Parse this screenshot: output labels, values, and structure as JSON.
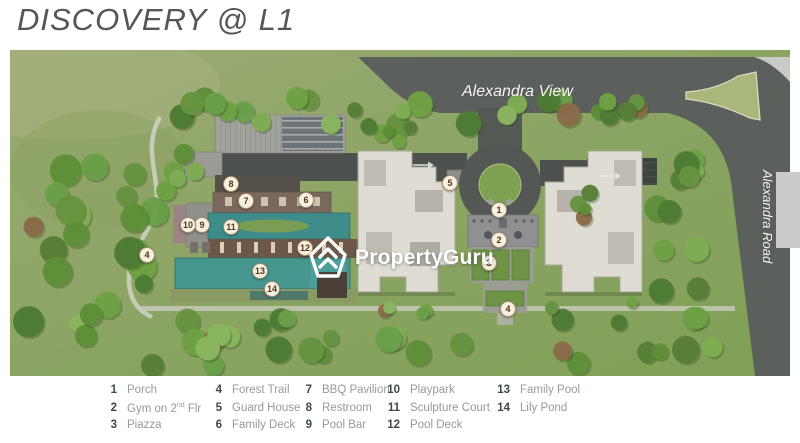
{
  "title": "DISCOVERY @ L1",
  "map": {
    "road_label_top": "Alexandra View",
    "road_label_right": "Alexandra Road",
    "watermark": "PropertyGuru",
    "badges": [
      {
        "num": "1",
        "x": 489,
        "y": 160
      },
      {
        "num": "2",
        "x": 489,
        "y": 190
      },
      {
        "num": "3",
        "x": 479,
        "y": 213
      },
      {
        "num": "4",
        "x": 137,
        "y": 205
      },
      {
        "num": "4",
        "x": 498,
        "y": 259
      },
      {
        "num": "5",
        "x": 440,
        "y": 133
      },
      {
        "num": "6",
        "x": 296,
        "y": 150
      },
      {
        "num": "7",
        "x": 236,
        "y": 151
      },
      {
        "num": "8",
        "x": 221,
        "y": 134
      },
      {
        "num": "9",
        "x": 192,
        "y": 175
      },
      {
        "num": "10",
        "x": 178,
        "y": 175
      },
      {
        "num": "11",
        "x": 221,
        "y": 177
      },
      {
        "num": "12",
        "x": 295,
        "y": 198
      },
      {
        "num": "13",
        "x": 250,
        "y": 221
      },
      {
        "num": "14",
        "x": 262,
        "y": 239
      }
    ]
  },
  "legend": {
    "columns": [
      {
        "items": [
          {
            "num": "1",
            "label": "Porch"
          },
          {
            "num": "2",
            "label_pre": "Gym on 2",
            "label_sup": "nd",
            "label_post": " Flr"
          },
          {
            "num": "3",
            "label": "Piazza"
          }
        ]
      },
      {
        "items": [
          {
            "num": "4",
            "label": "Forest Trail"
          },
          {
            "num": "5",
            "label": "Guard House"
          },
          {
            "num": "6",
            "label": "Family Deck"
          }
        ]
      },
      {
        "items": [
          {
            "num": "7",
            "label": "BBQ Pavilion"
          },
          {
            "num": "8",
            "label": "Restroom"
          },
          {
            "num": "9",
            "label": "Pool Bar"
          }
        ]
      },
      {
        "items": [
          {
            "num": "10",
            "label": "Playpark"
          },
          {
            "num": "11",
            "label": "Sculpture Court"
          },
          {
            "num": "12",
            "label": "Pool Deck"
          }
        ]
      },
      {
        "items": [
          {
            "num": "13",
            "label": "Family Pool"
          },
          {
            "num": "14",
            "label": "Lily Pond"
          }
        ]
      }
    ]
  },
  "colors": {
    "pool_teal": "#3f8d8a",
    "deck_brown": "#75594a",
    "road_gray": "#5c605c",
    "grass_light": "#9cab76",
    "grass_dark": "#7fa055",
    "building_offwhite": "#dedcd3",
    "badge_bg": "#f8f0dd",
    "badge_text": "#4d3820",
    "legend_num": "#3d484c",
    "legend_label": "#949b99",
    "watermark_white": "#ffffff"
  }
}
